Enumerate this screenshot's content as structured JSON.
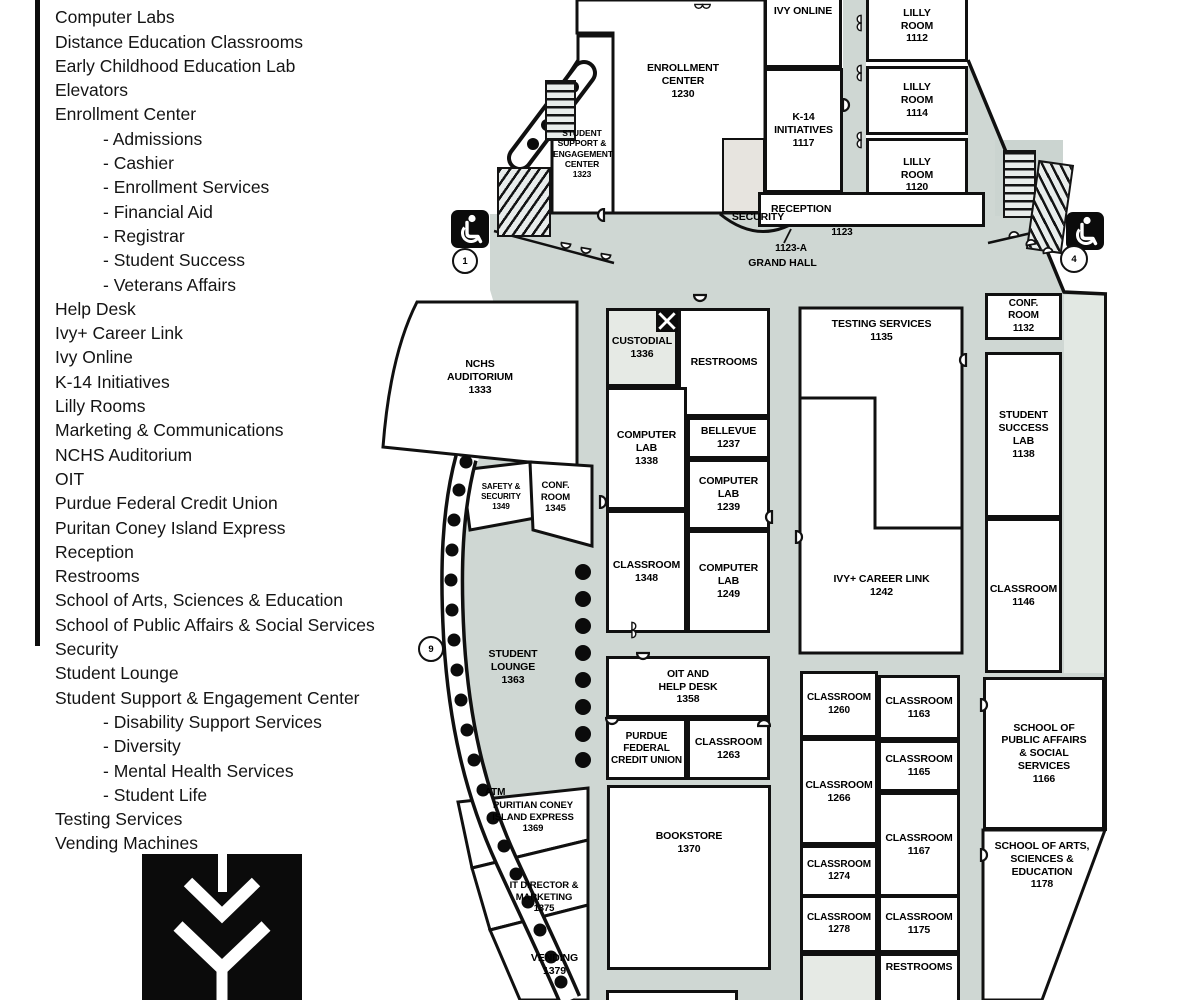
{
  "legend": {
    "items": [
      {
        "label": "Classrooms"
      },
      {
        "label": "Computer Labs"
      },
      {
        "label": "Distance Education Classrooms"
      },
      {
        "label": "Early Childhood Education Lab"
      },
      {
        "label": "Elevators",
        "icon": true
      },
      {
        "label": "Enrollment Center"
      },
      {
        "label": "- Admissions",
        "sub": true
      },
      {
        "label": "- Cashier",
        "sub": true
      },
      {
        "label": "- Enrollment Services",
        "sub": true
      },
      {
        "label": "- Financial Aid",
        "sub": true
      },
      {
        "label": "- Registrar",
        "sub": true
      },
      {
        "label": "- Student Success",
        "sub": true
      },
      {
        "label": "- Veterans Affairs",
        "sub": true
      },
      {
        "label": "Help Desk"
      },
      {
        "label": "Ivy+ Career Link"
      },
      {
        "label": "Ivy Online"
      },
      {
        "label": "K-14 Initiatives"
      },
      {
        "label": "Lilly Rooms"
      },
      {
        "label": "Marketing & Communications"
      },
      {
        "label": "NCHS Auditorium"
      },
      {
        "label": "OIT"
      },
      {
        "label": "Purdue Federal Credit Union"
      },
      {
        "label": "Puritan Coney Island Express"
      },
      {
        "label": "Reception"
      },
      {
        "label": "Restrooms"
      },
      {
        "label": "School of Arts, Sciences & Education"
      },
      {
        "label": "School of Public Affairs  & Social Services"
      },
      {
        "label": "Security"
      },
      {
        "label": "Student Lounge"
      },
      {
        "label": "Student Support & Engagement Center"
      },
      {
        "label": "- Disability Support Services",
        "sub": true
      },
      {
        "label": "- Diversity",
        "sub": true
      },
      {
        "label": "- Mental Health Services",
        "sub": true
      },
      {
        "label": "- Student Life",
        "sub": true
      },
      {
        "label": "Testing Services"
      },
      {
        "label": "Vending Machines"
      }
    ]
  },
  "map": {
    "rooms": {
      "enrollment_center": {
        "label": "ENROLLMENT\nCENTER\n1230"
      },
      "ivy_online": {
        "label": "IVY ONLINE"
      },
      "k14": {
        "label": "K-14\nINITIATIVES\n1117"
      },
      "ssec": {
        "label": "STUDENT\nSUPPORT &\nENGAGEMENT\nCENTER\n1323"
      },
      "reception": {
        "label": "RECEPTION"
      },
      "lilly_1112": {
        "label": "LILLY\nROOM\n1112"
      },
      "lilly_1114": {
        "label": "LILLY\nROOM\n1114"
      },
      "lilly_1120": {
        "label": "LILLY\nROOM\n1120"
      },
      "nchs": {
        "label": "NCHS\nAUDITORIUM\n1333"
      },
      "custodial": {
        "label": "CUSTODIAL\n1336"
      },
      "restrooms_top": {
        "label": "RESTROOMS"
      },
      "bellevue": {
        "label": "BELLEVUE\n1237"
      },
      "computer_lab_1338": {
        "label": "COMPUTER\nLAB\n1338"
      },
      "computer_lab_1239": {
        "label": "COMPUTER\nLAB\n1239"
      },
      "classroom_1348": {
        "label": "CLASSROOM\n1348"
      },
      "computer_lab_1249": {
        "label": "COMPUTER\nLAB\n1249"
      },
      "testing": {
        "label": "TESTING SERVICES\n1135"
      },
      "conf_1132": {
        "label": "CONF.\nROOM\n1132"
      },
      "ssl_1138": {
        "label": "STUDENT\nSUCCESS\nLAB\n1138"
      },
      "career_link": {
        "label": "IVY+ CAREER LINK\n1242"
      },
      "classroom_1146": {
        "label": "CLASSROOM\n1146"
      },
      "safety": {
        "label": "SAFETY &\nSECURITY\n1349"
      },
      "conf_1345": {
        "label": "CONF.\nROOM\n1345"
      },
      "student_lounge": {
        "label": "STUDENT\nLOUNGE\n1363"
      },
      "oit": {
        "label": "OIT AND\nHELP DESK\n1358"
      },
      "pfcu": {
        "label": "PURDUE\nFEDERAL\nCREDIT UNION"
      },
      "classroom_1263": {
        "label": "CLASSROOM\n1263"
      },
      "bookstore": {
        "label": "BOOKSTORE\n1370"
      },
      "classroom_1260": {
        "label": "CLASSROOM\n1260"
      },
      "classroom_1163": {
        "label": "CLASSROOM\n1163"
      },
      "classroom_1266": {
        "label": "CLASSROOM\n1266"
      },
      "classroom_1165": {
        "label": "CLASSROOM\n1165"
      },
      "classroom_1167": {
        "label": "CLASSROOM\n1167"
      },
      "classroom_1274": {
        "label": "CLASSROOM\n1274"
      },
      "classroom_1278": {
        "label": "CLASSROOM\n1278"
      },
      "classroom_1175": {
        "label": "CLASSROOM\n1175"
      },
      "restrooms_bottom": {
        "label": "RESTROOMS"
      },
      "school_public": {
        "label": "SCHOOL OF\nPUBLIC  AFFAIRS\n& SOCIAL\nSERVICES\n1166"
      },
      "school_arts": {
        "label": "SCHOOL OF ARTS,\nSCIENCES &\nEDUCATION\n1178"
      },
      "puritan": {
        "label": "PURITIAN CONEY\nISLAND EXPRESS\n1369"
      },
      "it_director": {
        "label": "IT DIRECTOR &\nMARKETING\n1375"
      },
      "vending": {
        "label": "VENDING\n1379"
      }
    },
    "labels": {
      "grand_hall": "GRAND HALL",
      "security": "SECURITY",
      "security_num": "1123-A",
      "reception_num": "1123",
      "atm": "ATM"
    },
    "markers": {
      "exit1": "1",
      "exit4": "4",
      "exit9": "9"
    },
    "colors": {
      "corridor": "#cfd7d3",
      "shade": "#e6eae5",
      "wall": "#101010"
    }
  }
}
